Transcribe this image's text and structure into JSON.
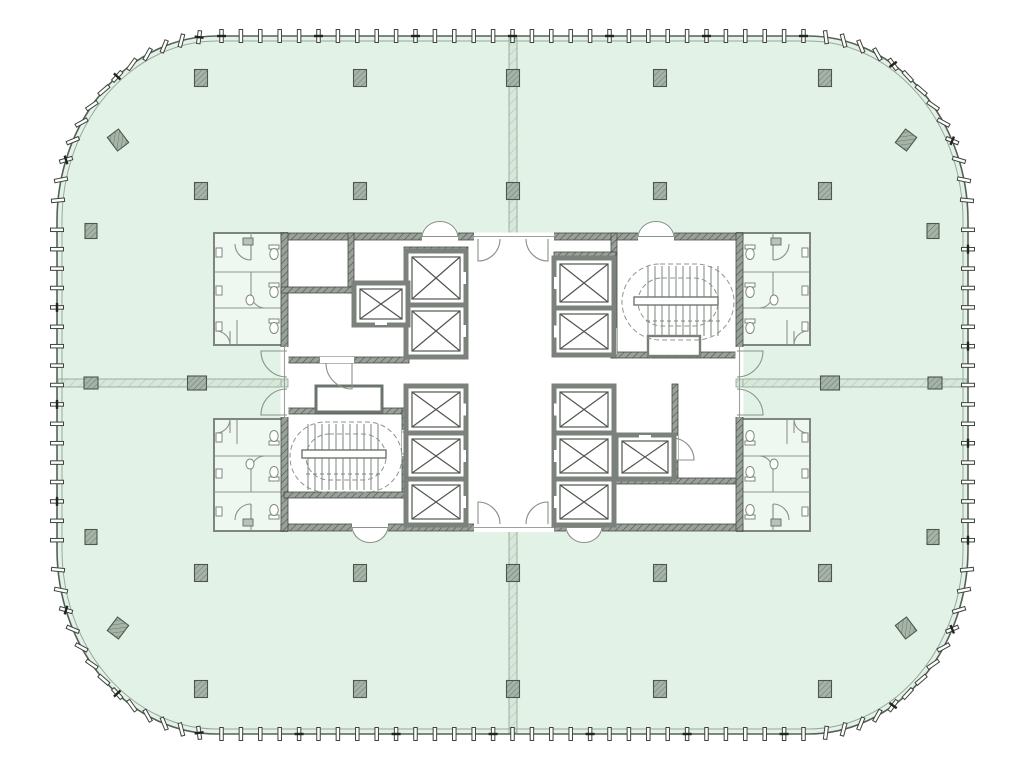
{
  "document": {
    "type": "architectural-floor-plan",
    "description": "Typical high-rise tower floor plate: rounded-square curtain wall, open office floor, central service core",
    "visible_text": []
  },
  "palette": {
    "page_bg": "#ffffff",
    "floor_fill": "#e3f2e7",
    "facade_outer_line": "#566057",
    "facade_inner_line": "#9aa69b",
    "wall_hatch_bg": "#9aa09a",
    "wall_hatch_line": "#565c56",
    "demising_bg": "#d7e8db",
    "demising_line": "#aac3af",
    "column_bg": "#a6b4a8",
    "column_line": "#6c7a6e",
    "detail_line": "#8a928a",
    "restroom_fill": "#eef7f0"
  },
  "facade": {
    "outer": {
      "x": 57,
      "y": 36,
      "w": 911,
      "h": 698,
      "rx": 160,
      "ry": 185
    },
    "inner_offset": 5,
    "tick": {
      "spacing": 19.4,
      "w": 3.5,
      "len": 13
    },
    "accent_every": 5
  },
  "inventory": {
    "passenger_elevators": 10,
    "service_shafts": 2,
    "stairs": 2,
    "restroom_wings": 4,
    "structural_columns": 32
  },
  "columns": {
    "grid_xs": [
      201,
      360,
      513,
      660,
      825
    ],
    "grid_ys": [
      78,
      191,
      573,
      689
    ],
    "grid_size": [
      13,
      17
    ],
    "edge": [
      [
        91,
        231
      ],
      [
        933,
        231
      ],
      [
        91,
        537
      ],
      [
        933,
        537
      ]
    ],
    "edge_size": [
      12,
      15
    ],
    "mid": [
      [
        197,
        383,
        19,
        14
      ],
      [
        830,
        383,
        19,
        14
      ],
      [
        91,
        383,
        14,
        12
      ],
      [
        935,
        383,
        14,
        12
      ]
    ],
    "rotated": [
      [
        118,
        140,
        -37
      ],
      [
        906,
        140,
        37
      ],
      [
        118,
        628,
        37
      ],
      [
        906,
        628,
        -37
      ]
    ],
    "rotated_size": [
      14,
      17
    ]
  },
  "demising_walls": [
    [
      509,
      38,
      8,
      196
    ],
    [
      509,
      531,
      8,
      202
    ],
    [
      58,
      379,
      223,
      8
    ],
    [
      743,
      379,
      224,
      8
    ]
  ],
  "core": {
    "outer": {
      "x": 281,
      "y": 233,
      "w": 462,
      "h": 298
    },
    "walls": [
      [
        281,
        233,
        462,
        7
      ],
      [
        281,
        524,
        462,
        7
      ],
      [
        281,
        233,
        7,
        298
      ],
      [
        736,
        233,
        7,
        298
      ],
      [
        348,
        233,
        6,
        60
      ],
      [
        281,
        287,
        73,
        6
      ],
      [
        281,
        357,
        128,
        6
      ],
      [
        284,
        408,
        124,
        6
      ],
      [
        402,
        408,
        6,
        90
      ],
      [
        284,
        492,
        124,
        6
      ],
      [
        611,
        233,
        6,
        125
      ],
      [
        611,
        352,
        132,
        6
      ],
      [
        554,
        252,
        62,
        5
      ],
      [
        404,
        247,
        64,
        6
      ],
      [
        672,
        384,
        6,
        96
      ],
      [
        614,
        478,
        122,
        6
      ]
    ],
    "gaps": [
      [
        474,
        232.5,
        80,
        8.5
      ],
      [
        474,
        523.5,
        80,
        8.5
      ],
      [
        280.5,
        347,
        8,
        70
      ],
      [
        735.5,
        347,
        8,
        70
      ],
      [
        422,
        232.5,
        36,
        8.5
      ],
      [
        638,
        232.5,
        36,
        8.5
      ],
      [
        352,
        523.5,
        36,
        8.5
      ],
      [
        566,
        523.5,
        36,
        8.5
      ],
      [
        320,
        357,
        34,
        6
      ],
      [
        611,
        328,
        6,
        26
      ],
      [
        402,
        430,
        6,
        26
      ],
      [
        672,
        436,
        6,
        24
      ]
    ],
    "stubs": [
      [
        281,
        379,
        7,
        8
      ],
      [
        736,
        379,
        7,
        8
      ]
    ],
    "thin_lines": [
      [
        474,
        236.5,
        554,
        236.5
      ],
      [
        474,
        527.5,
        554,
        527.5
      ],
      [
        284.5,
        347,
        284.5,
        417
      ],
      [
        739.5,
        347,
        739.5,
        417
      ]
    ],
    "bumps": [
      {
        "x": 422,
        "y": 236.5,
        "w": 36,
        "dir": "up"
      },
      {
        "x": 638,
        "y": 236.5,
        "w": 36,
        "dir": "up"
      },
      {
        "x": 352,
        "y": 527.5,
        "w": 36,
        "dir": "down"
      },
      {
        "x": 566,
        "y": 527.5,
        "w": 36,
        "dir": "down"
      }
    ],
    "small_room": [
      648,
      336,
      52,
      20
    ],
    "vestibule": [
      316,
      386,
      66,
      26
    ]
  },
  "elevators": [
    [
      406,
      251,
      60,
      54,
      "e"
    ],
    [
      406,
      305,
      60,
      52,
      "e"
    ],
    [
      554,
      258,
      60,
      50,
      "w"
    ],
    [
      554,
      308,
      60,
      47,
      "w"
    ],
    [
      406,
      386,
      60,
      47,
      "e"
    ],
    [
      406,
      433,
      60,
      46,
      "e"
    ],
    [
      406,
      479,
      60,
      46,
      "e"
    ],
    [
      554,
      386,
      60,
      47,
      "w"
    ],
    [
      554,
      433,
      60,
      46,
      "w"
    ],
    [
      554,
      479,
      60,
      46,
      "w"
    ]
  ],
  "service_shafts": [
    [
      354,
      283,
      54,
      42,
      "s"
    ],
    [
      616,
      435,
      58,
      44,
      "n"
    ]
  ],
  "stairs": [
    {
      "oval": [
        622,
        264,
        112,
        76
      ],
      "inner": [
        638,
        278,
        80,
        48
      ],
      "landing": [
        634,
        297,
        84,
        8
      ],
      "tread_x0": 648,
      "tread_x1": 718,
      "step": 7,
      "y_top": 266,
      "y_mid1": 297,
      "y_mid2": 305,
      "y_bot": 336,
      "ticks_y": 321
    },
    {
      "oval": [
        290,
        422,
        112,
        70
      ],
      "inner": [
        306,
        434,
        80,
        46
      ],
      "landing": [
        302,
        450,
        84,
        8
      ],
      "tread_x0": 308,
      "tread_x1": 378,
      "step": 7,
      "y_top": 424,
      "y_mid1": 450,
      "y_mid2": 458,
      "y_bot": 490,
      "ticks_y": 474
    }
  ],
  "doors": [
    "M478,239 L478,261 A22,22 0 0 0 500,239",
    "M548,239 L548,261 A22,22 0 0 1 526,239",
    "M478,524 L478,502 A22,22 0 0 1 500,524",
    "M548,524 L548,502 A22,22 0 0 0 526,524",
    "M287,351 L261,351 A26,26 0 0 0 287,377",
    "M287,415 L261,415 A26,26 0 0 1 287,389",
    "M737,351 L763,351 A26,26 0 0 1 737,377",
    "M737,415 L763,415 A26,26 0 0 0 737,389",
    "M352,363 L352,389 A26,26 0 0 1 326,363",
    "M611,330 L589,330 A22,22 0 0 0 611,352",
    "M402,432 L424,432 A22,22 0 0 1 402,454",
    "M672,460 L694,460 A22,22 0 0 0 672,438"
  ],
  "restroom_wing": {
    "base": {
      "x": 214,
      "y": 233,
      "w": 73,
      "h": 112
    },
    "mirrors": [
      {
        "name": "top-left",
        "tx": 0,
        "ty": 0,
        "sx": 1,
        "sy": 1
      },
      {
        "name": "top-right",
        "tx": 1024,
        "ty": 0,
        "sx": -1,
        "sy": 1
      },
      {
        "name": "bottom-left",
        "tx": 0,
        "ty": 764,
        "sx": 1,
        "sy": -1
      },
      {
        "name": "bottom-right",
        "tx": 1024,
        "ty": 764,
        "sx": -1,
        "sy": -1
      }
    ]
  }
}
